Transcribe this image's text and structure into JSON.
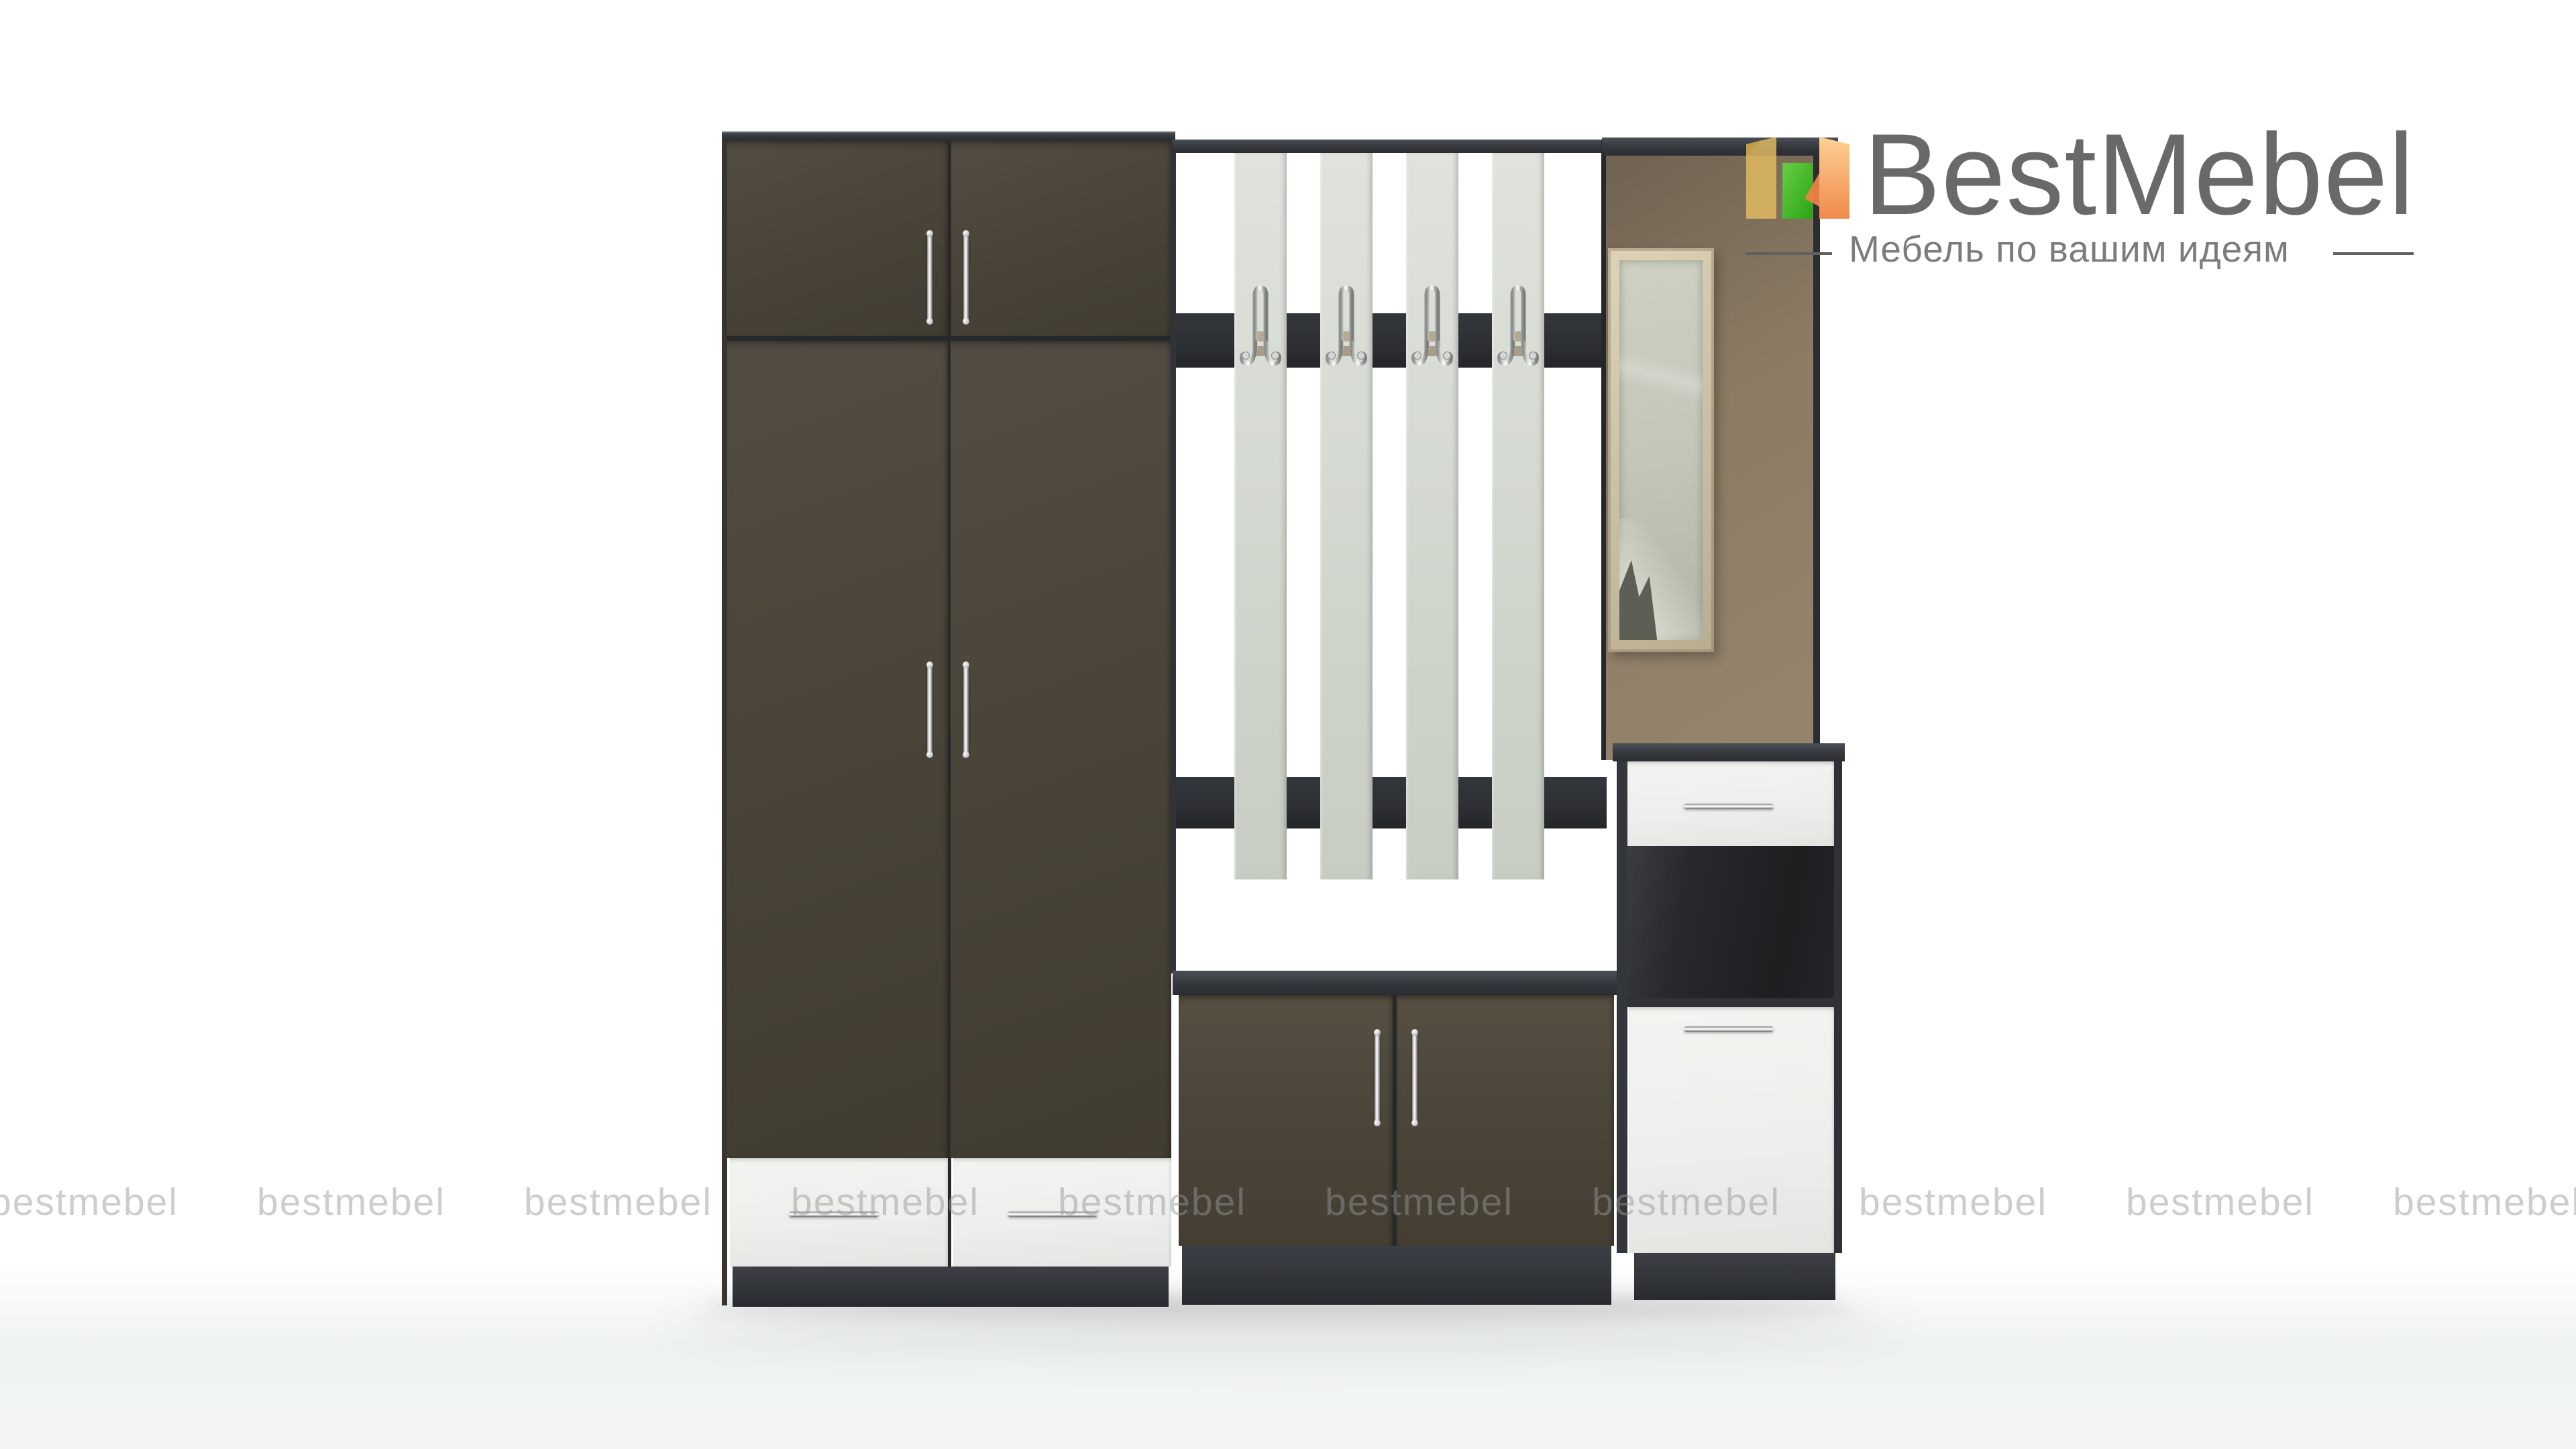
{
  "brand": {
    "name": "BestMebel",
    "tagline": "Мебель по вашим идеям"
  },
  "watermark": {
    "text": "bestmebel",
    "count": 10
  },
  "colors": {
    "wenge_front": "#4a4439",
    "carcass_dark": "#34373c",
    "bar_dark": "#2c2f33",
    "plinth_dark": "#2f3237",
    "white_front": "#ecefeb",
    "slat_top": "#dfe3dc",
    "slat_bottom": "#c7cdc2",
    "panel_brown": "#8b7b64",
    "panel_brown_dark": "#6e6150",
    "mirror_frame": "#cdc2a7",
    "mirror_glass": "#c2c7b9",
    "reflection_dark": "#5c6054",
    "niche_dark": "#1c1e20",
    "hook_plate": "#b0a78f",
    "logo_text": "#696969",
    "tagline_text": "#7c7c7c",
    "logo_yellow": "#e7bf61",
    "logo_green": "#2fae17",
    "logo_orange": "#f2934e",
    "watermark": "rgba(150,150,150,0.62)",
    "floor_shadow": "#f3f5f5"
  }
}
